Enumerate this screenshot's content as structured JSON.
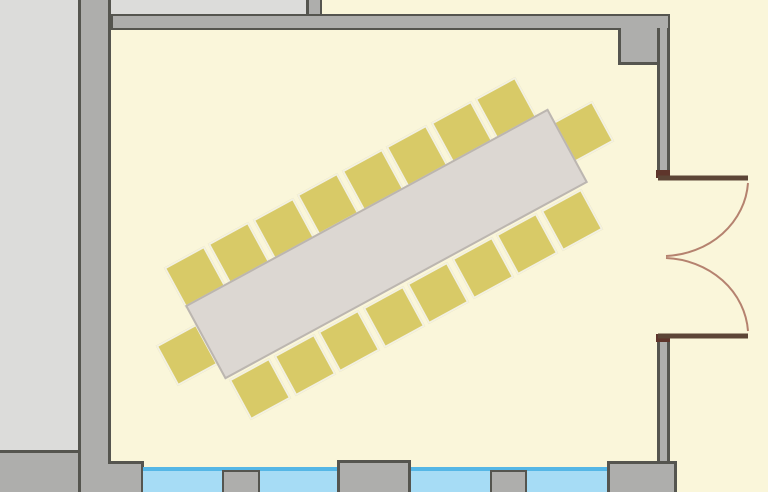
{
  "palette": {
    "floor": "#faf6da",
    "wall": "#aeaeac",
    "outline": "#55554f",
    "adj": "#dcdcda",
    "glass": "#a6dcf5",
    "glassframe": "#55b7e6",
    "chair": "#d8ca67",
    "chairborder": "#f3f1e2",
    "table": "#dcd7d2",
    "tableborder": "#bcb6b0",
    "leaf": "#5c4536",
    "arc": "#b5826f",
    "jamb": "#5e352b"
  },
  "plan": {
    "type": "floor-plan",
    "room": "meeting-room",
    "adjacent_rooms": 2,
    "door": {
      "type": "double-swing-door",
      "leaf_count": 2,
      "location": "right-wall"
    },
    "windows": {
      "count": 4,
      "location": "bottom-wall"
    },
    "furniture": {
      "table_count": 1,
      "chair_count": 18,
      "chairs_long_side_each": 8,
      "chairs_ends_each": 1
    }
  },
  "table_group": {
    "cx": 386,
    "cy": 243.5,
    "angle_deg": -28.5,
    "table": {
      "length": 413,
      "width": 84
    },
    "chair_size": 46,
    "chairs": [
      {
        "u": -184,
        "v": -62
      },
      {
        "u": -133.4,
        "v": -62
      },
      {
        "u": -82.8,
        "v": -62
      },
      {
        "u": -32.2,
        "v": -62
      },
      {
        "u": 18.4,
        "v": -62
      },
      {
        "u": 69,
        "v": -62
      },
      {
        "u": 119.6,
        "v": -62
      },
      {
        "u": 170.2,
        "v": -62
      },
      {
        "u": -180,
        "v": 68
      },
      {
        "u": -129.4,
        "v": 68
      },
      {
        "u": -78.8,
        "v": 68
      },
      {
        "u": -28.2,
        "v": 68
      },
      {
        "u": 22.4,
        "v": 68
      },
      {
        "u": 73,
        "v": 68
      },
      {
        "u": 123.6,
        "v": 68
      },
      {
        "u": 174.2,
        "v": 68
      },
      {
        "u": -228,
        "v": 3
      },
      {
        "u": 226,
        "v": -4
      }
    ]
  }
}
